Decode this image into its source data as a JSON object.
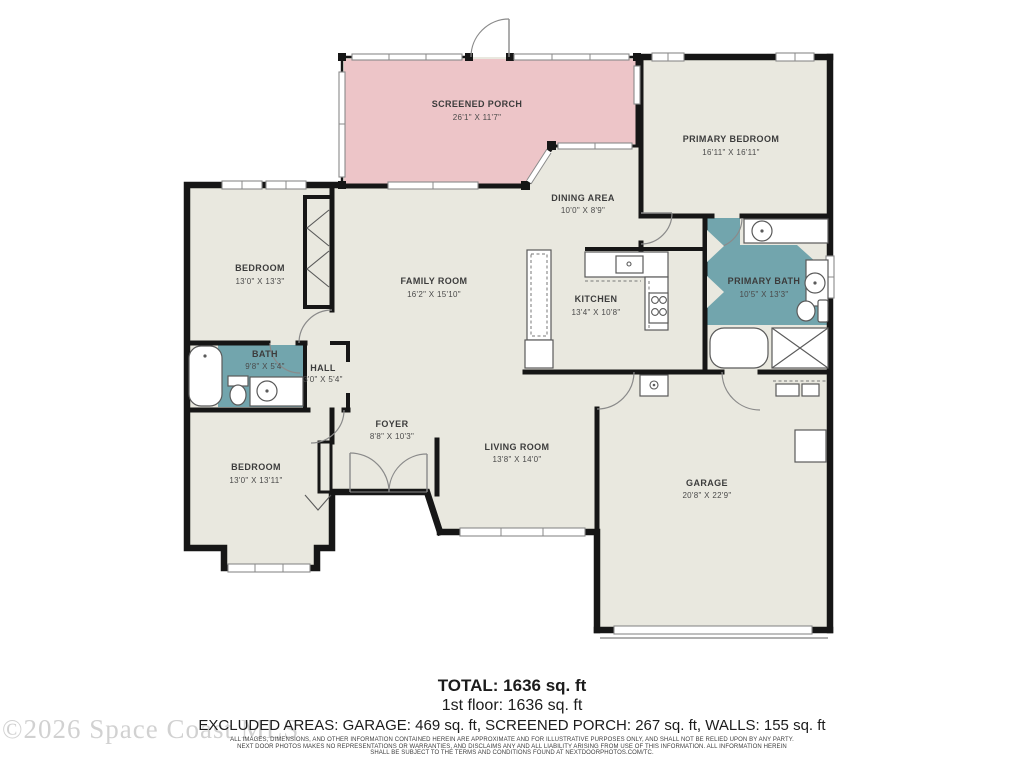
{
  "title": "Floor Plan",
  "colors": {
    "floor": "#e9e8df",
    "porch": "#edc5c8",
    "bath": "#72a5ad",
    "wall": "#161616"
  },
  "rooms": [
    {
      "id": "screened-porch",
      "name": "SCREENED PORCH",
      "dims": "26'1\" X 11'7\""
    },
    {
      "id": "primary-bedroom",
      "name": "PRIMARY BEDROOM",
      "dims": "16'11\" X 16'11\""
    },
    {
      "id": "dining-area",
      "name": "DINING AREA",
      "dims": "10'0\" X 8'9\""
    },
    {
      "id": "family-room",
      "name": "FAMILY ROOM",
      "dims": "16'2\" X 15'10\""
    },
    {
      "id": "kitchen",
      "name": "KITCHEN",
      "dims": "13'4\" X 10'8\""
    },
    {
      "id": "primary-bath",
      "name": "PRIMARY BATH",
      "dims": "10'5\" X 13'3\""
    },
    {
      "id": "bedroom-top",
      "name": "BEDROOM",
      "dims": "13'0\" X 13'3\""
    },
    {
      "id": "bath",
      "name": "BATH",
      "dims": "9'8\" X 5'4\""
    },
    {
      "id": "hall",
      "name": "HALL",
      "dims": "3'0\" X 5'4\""
    },
    {
      "id": "bedroom-bottom",
      "name": "BEDROOM",
      "dims": "13'0\" X 13'11\""
    },
    {
      "id": "foyer",
      "name": "FOYER",
      "dims": "8'8\" X 10'3\""
    },
    {
      "id": "living-room",
      "name": "LIVING ROOM",
      "dims": "13'8\" X 14'0\""
    },
    {
      "id": "garage",
      "name": "GARAGE",
      "dims": "20'8\" X 22'9\""
    }
  ],
  "summary": {
    "total": "TOTAL: 1636 sq. ft",
    "first_floor": "1st floor: 1636 sq. ft",
    "excluded": "EXCLUDED AREAS: GARAGE: 469 sq. ft, SCREENED PORCH: 267 sq. ft, WALLS: 155 sq. ft"
  },
  "disclaimer": [
    "ALL IMAGES, DIMENSIONS, AND OTHER INFORMATION CONTAINED HEREIN ARE APPROXIMATE AND FOR ILLUSTRATIVE PURPOSES ONLY, AND SHALL NOT BE RELIED UPON BY ANY PARTY.",
    "NEXT DOOR PHOTOS MAKES NO REPRESENTATIONS OR WARRANTIES, AND DISCLAIMS ANY AND ALL LIABILITY ARISING FROM USE OF THIS INFORMATION. ALL INFORMATION HEREIN",
    "SHALL BE SUBJECT TO THE TERMS AND CONDITIONS FOUND AT NEXTDOORPHOTOS.COM/TC."
  ],
  "watermark": "©2026 Space Coast MLS"
}
